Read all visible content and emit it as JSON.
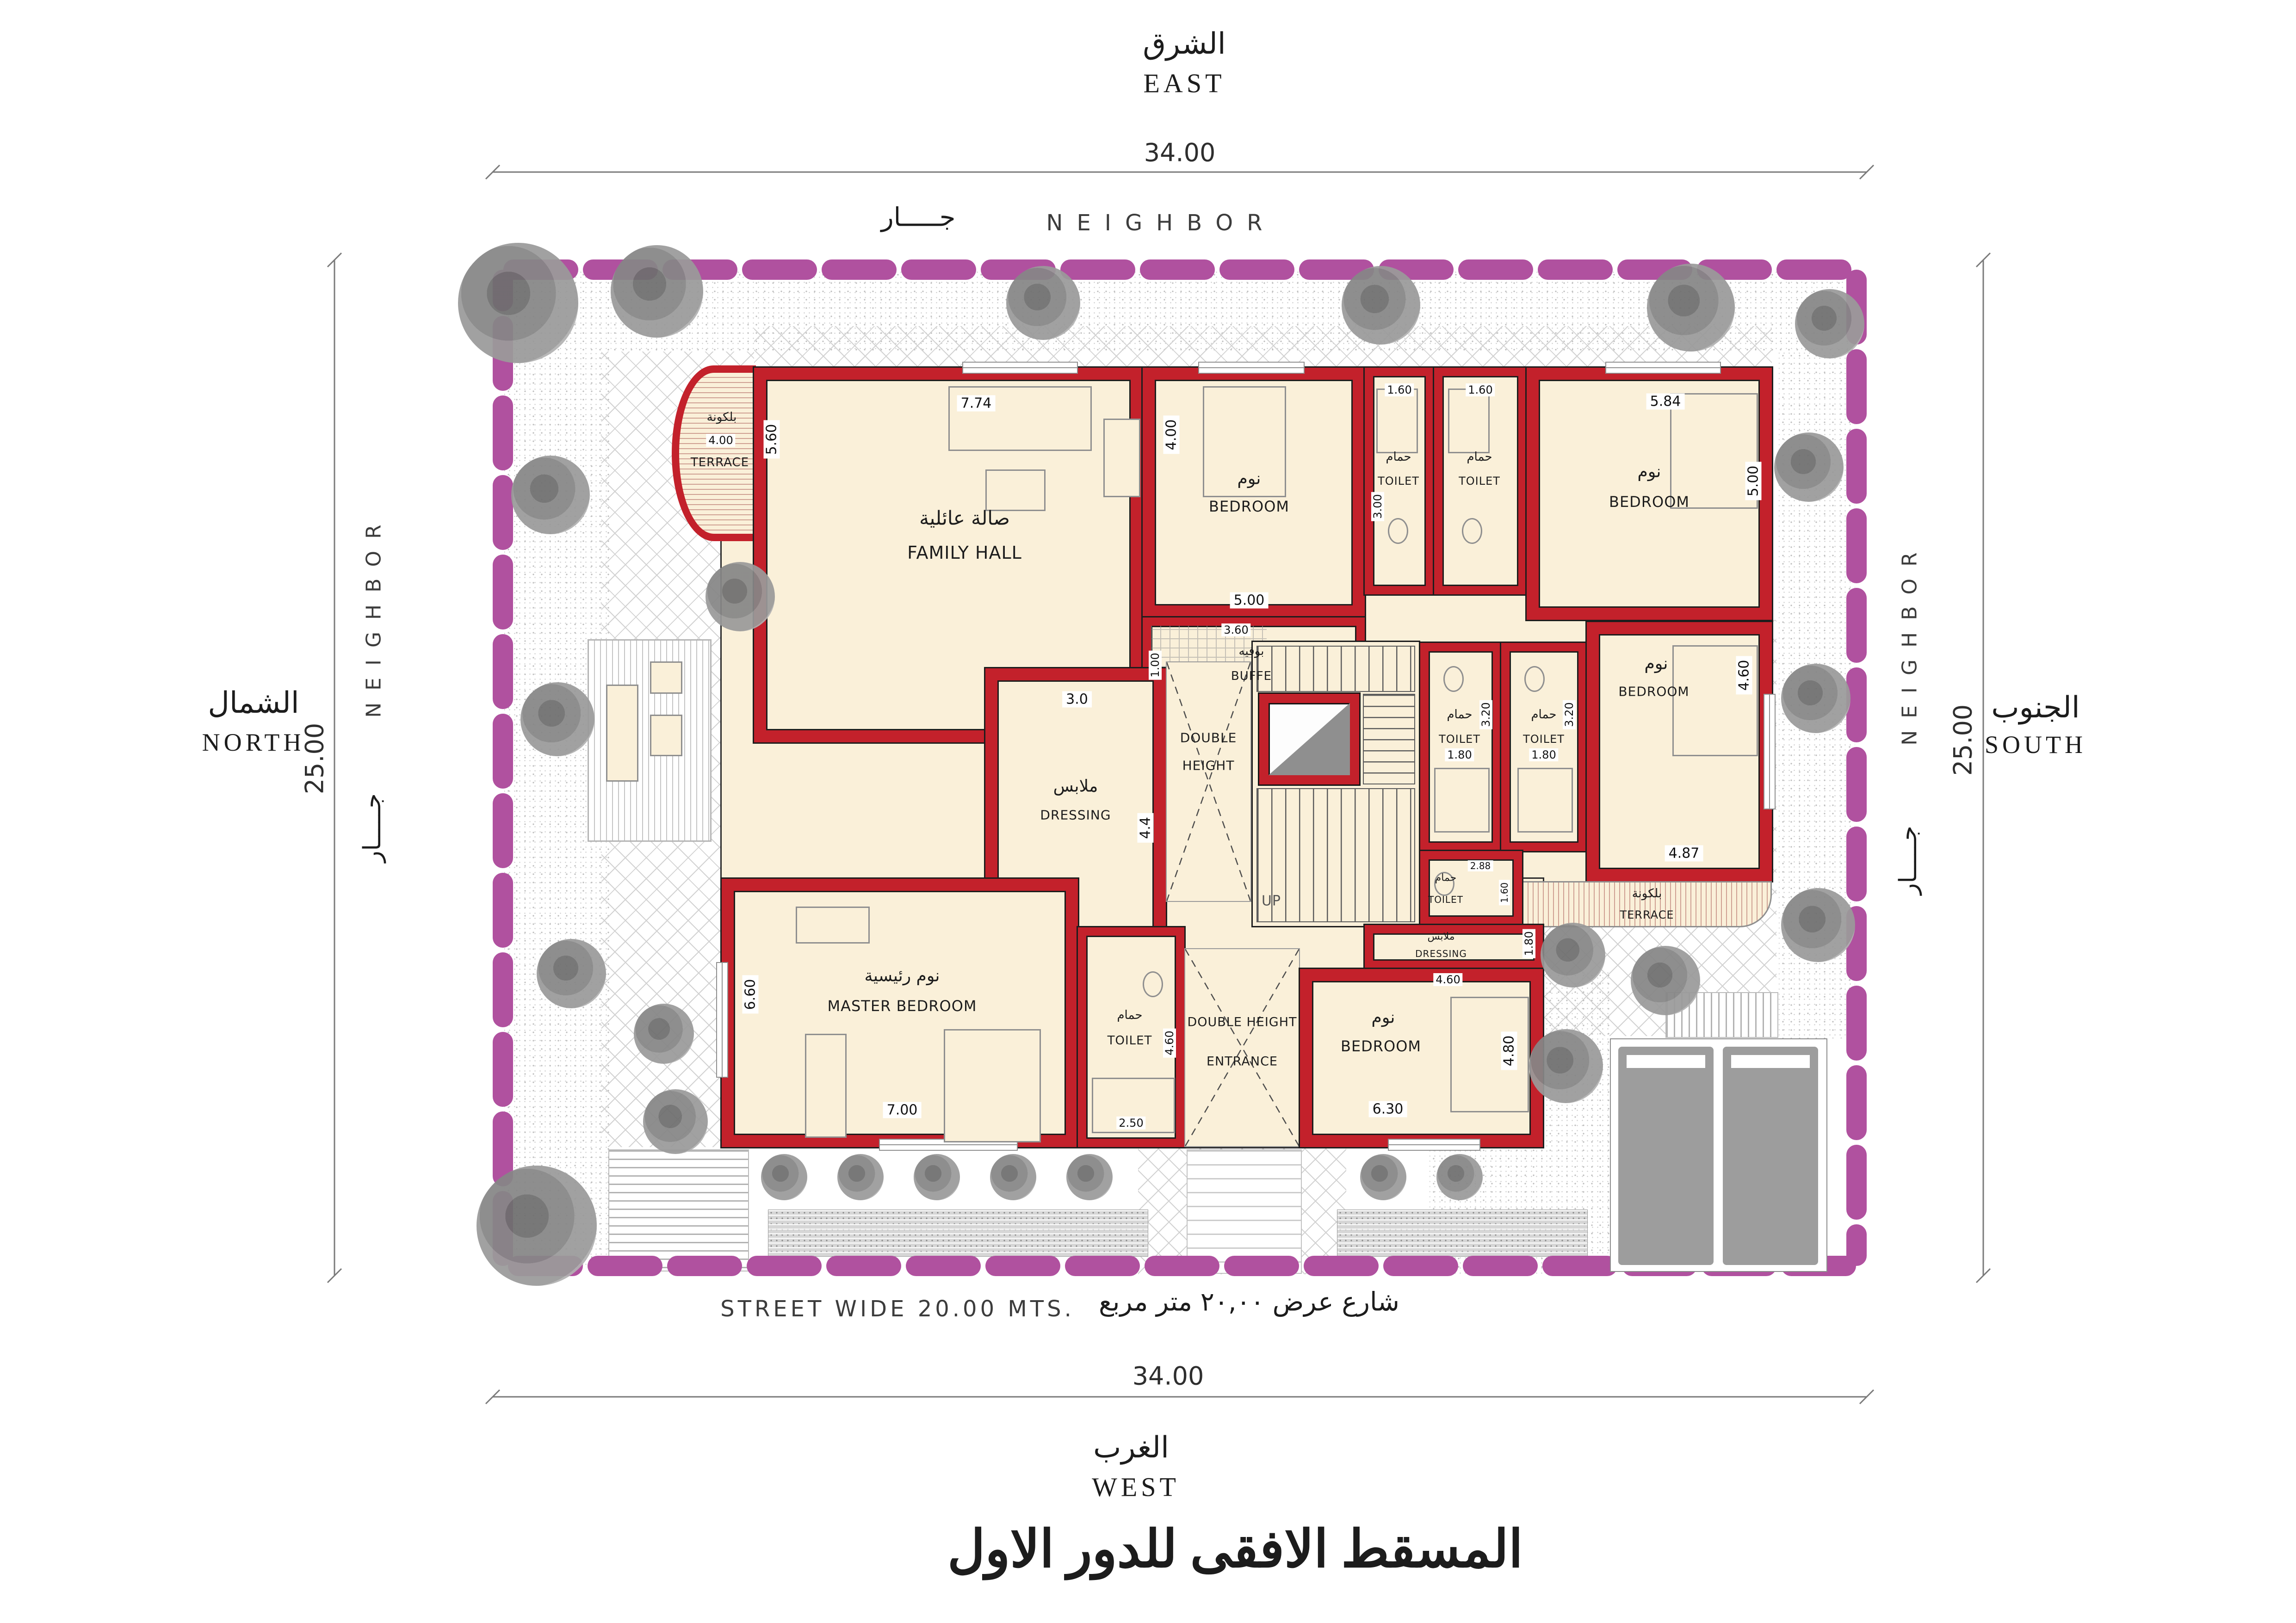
{
  "palette": {
    "wall_red": "#c3212b",
    "boundary_purple": "#b0519f",
    "floor_cream": "#faf0d9",
    "tree_gray": "#8a8a8a",
    "car_gray": "#a9a9a9"
  },
  "compass": {
    "east_ar": "الشرق",
    "east_en": "EAST",
    "west_ar": "الغرب",
    "west_en": "WEST",
    "north_ar": "الشمال",
    "north_en": "NORTH",
    "south_ar": "الجنوب",
    "south_en": "SOUTH"
  },
  "boundary": {
    "neighbor_en": "NEIGHBOR",
    "neighbor_ar": "جـــــار",
    "dim_top": "34.00",
    "dim_bottom": "34.00",
    "dim_left": "25.00",
    "dim_right": "25.00"
  },
  "street": {
    "en": "STREET  WIDE  20.00  MTS.",
    "ar": "شارع عرض ٢٠,٠٠ متر مربع"
  },
  "title_ar": "المسقط الافقى للدور الاول",
  "rooms": {
    "family_hall": {
      "ar": "صالة عائلية",
      "en": "FAMILY HALL",
      "dim_w": "7.74",
      "dim_h": "5.60"
    },
    "terrace_main": {
      "ar": "بلكونة",
      "en": "TERRACE",
      "dim": "4.00"
    },
    "bedroom_top_left": {
      "ar": "نوم",
      "en": "BEDROOM",
      "dim_w": "5.00",
      "dim_h": "4.00"
    },
    "toilet_top_1": {
      "ar": "حمام",
      "en": "TOILET",
      "dim_w": "1.60",
      "dim_h": "3.00"
    },
    "toilet_top_2": {
      "ar": "حمام",
      "en": "TOILET",
      "dim_w": "1.60"
    },
    "bedroom_top_right": {
      "ar": "نوم",
      "en": "BEDROOM",
      "dim_w": "5.84",
      "dim_h": "5.00"
    },
    "buffe": {
      "ar": "بوفيه",
      "en": "BUFFE",
      "dim_w": "3.60",
      "dim_h": "1.00"
    },
    "dressing_left": {
      "ar": "ملابس",
      "en": "DRESSING",
      "dim_w": "3.0",
      "dim_h": "4.4"
    },
    "double_height_void": {
      "en_1": "DOUBLE",
      "en_2": "HEIGHT"
    },
    "stairs": {
      "up": "UP"
    },
    "toilet_mid_1": {
      "ar": "حمام",
      "en": "TOILET",
      "dim_w": "1.80",
      "dim_h": "3.20"
    },
    "toilet_mid_2": {
      "ar": "حمام",
      "en": "TOILET",
      "dim_w": "1.80",
      "dim_h": "3.20"
    },
    "bedroom_right": {
      "ar": "نوم",
      "en": "BEDROOM",
      "dim_w": "4.87",
      "dim_h": "4.60"
    },
    "terrace_right": {
      "ar": "بلكونة",
      "en": "TERRACE"
    },
    "toilet_small": {
      "ar": "حمام",
      "en": "TOILET",
      "dim_w": "2.88",
      "dim_h": "1.60"
    },
    "dressing_right": {
      "ar": "ملابس",
      "en": "DRESSING",
      "dim_w": "4.60",
      "dim_h": "1.80"
    },
    "master_bedroom": {
      "ar": "نوم رئيسية",
      "en": "MASTER BEDROOM",
      "dim_w": "7.00",
      "dim_h": "6.60"
    },
    "toilet_master": {
      "ar": "حمام",
      "en": "TOILET",
      "dim_w": "2.50",
      "dim_h": "4.60"
    },
    "entrance": {
      "en_1": "DOUBLE HEIGHT",
      "en_2": "ENTRANCE"
    },
    "bedroom_bottom": {
      "ar": "نوم",
      "en": "BEDROOM",
      "dim_w": "6.30",
      "dim_h": "4.80"
    }
  }
}
